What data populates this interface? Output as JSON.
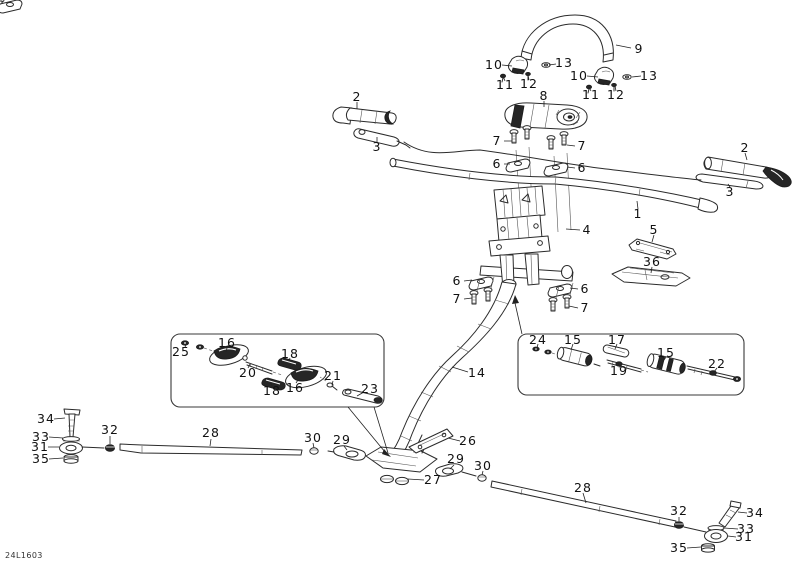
{
  "doc": {
    "drawing_code": "24L1603"
  },
  "callouts": {
    "strap": "9",
    "strap_clamp_left": "10",
    "strap_washer_left": "13",
    "strap_screw_left_a": "11",
    "strap_screw_left_b": "12",
    "strap_clamp_right": "10",
    "strap_washer_right": "13",
    "strap_screw_right_a": "11",
    "strap_screw_right_b": "12",
    "pad": "8",
    "grip_left": "2",
    "lever_left": "3",
    "grip_right": "2",
    "lever_right": "3",
    "handlebar": "1",
    "riser_bolt_left": "7",
    "riser_bolt_right": "7",
    "riser_clamp_left": "6",
    "riser_clamp_right": "6",
    "steering_column": "4",
    "bracket_small": "5",
    "bracket_wide": "36",
    "lower_clamp_left": "6",
    "lower_bolt_left": "7",
    "lower_clamp_right": "6",
    "lower_bolt_right": "7",
    "steering_shaft": "14",
    "inset_left_washers": "25",
    "inset_left_clamp_upper": "16",
    "inset_left_strip_upper": "18",
    "inset_left_rod": "20",
    "inset_left_strip_lower": "18",
    "inset_left_clamp_lower": "16",
    "inset_left_bolt": "21",
    "inset_left_link": "23",
    "inset_right_washers": "24",
    "inset_right_damper_left": "15",
    "inset_right_strip": "17",
    "inset_right_rod": "19",
    "inset_right_damper_right": "15",
    "inset_right_link": "22",
    "tierod_left_bolt": "34",
    "tierod_left_washer": "33",
    "tierod_left_balljoint": "31",
    "tierod_left_spacer": "35",
    "tierod_left_nut_outer": "32",
    "tierod_left_rod": "28",
    "tierod_left_nut_inner": "30",
    "tierod_left_end": "29",
    "base_bracket": "26",
    "base_nuts": "27",
    "tierod_right_end": "29",
    "tierod_right_nut_inner": "30",
    "tierod_right_rod": "28",
    "tierod_right_nut_outer": "32",
    "tierod_right_bolt": "34",
    "tierod_right_washer": "33",
    "tierod_right_balljoint": "31",
    "tierod_right_spacer": "35"
  }
}
